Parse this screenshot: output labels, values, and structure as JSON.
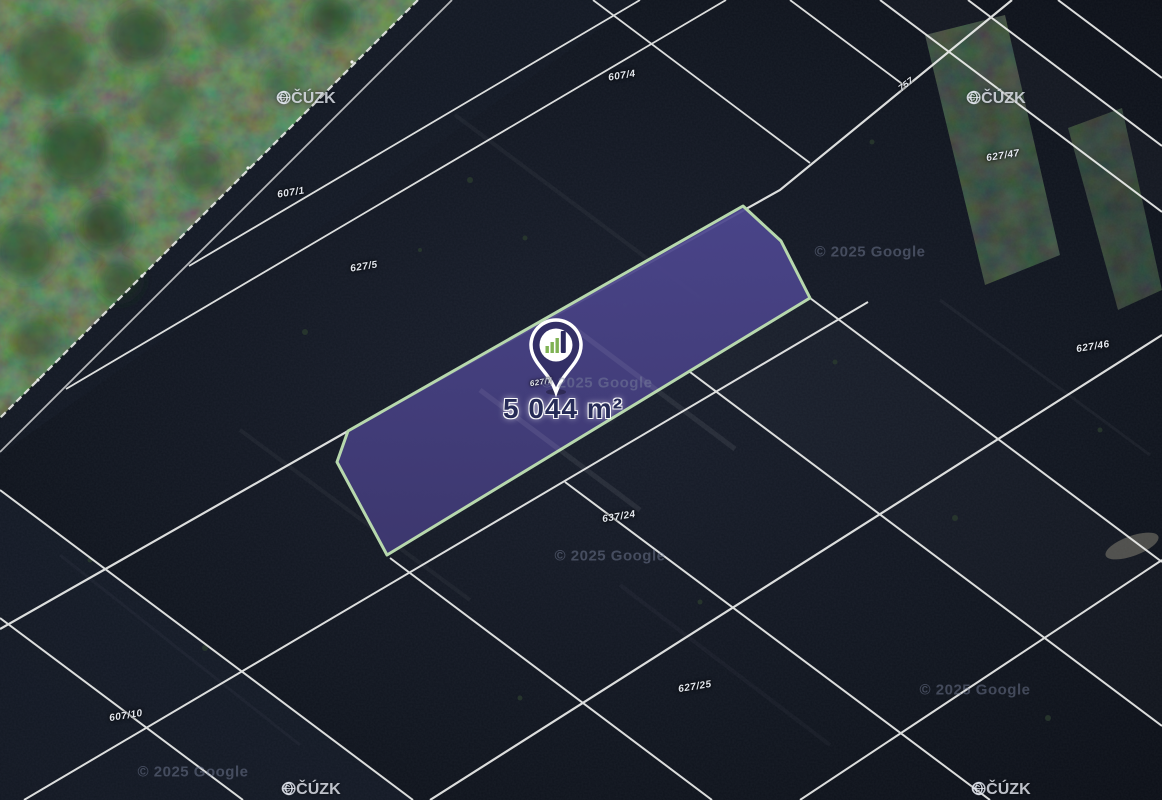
{
  "map": {
    "area_label": "5 044 m²",
    "selected_parcel": {
      "area_text": "5 044 m²",
      "fill_color": "#474180",
      "outline_color": "#b7d8ad"
    },
    "pin": {
      "logo": "bar-chart",
      "body_color": "#332f66",
      "bar_green": "#7fb254",
      "bar_navy": "#2c2a5e"
    },
    "parcel_labels": [
      {
        "text": "607/1"
      },
      {
        "text": "607/4"
      },
      {
        "text": "757"
      },
      {
        "text": "627/47"
      },
      {
        "text": "627/5"
      },
      {
        "text": "627/46"
      },
      {
        "text": "627/7"
      },
      {
        "text": "637/24"
      },
      {
        "text": "627/25"
      },
      {
        "text": "607/10"
      }
    ],
    "attribution": {
      "copyright_symbol": "©",
      "cuzk_label": "ČÚZK",
      "google_label": "© 2025 Google"
    }
  }
}
